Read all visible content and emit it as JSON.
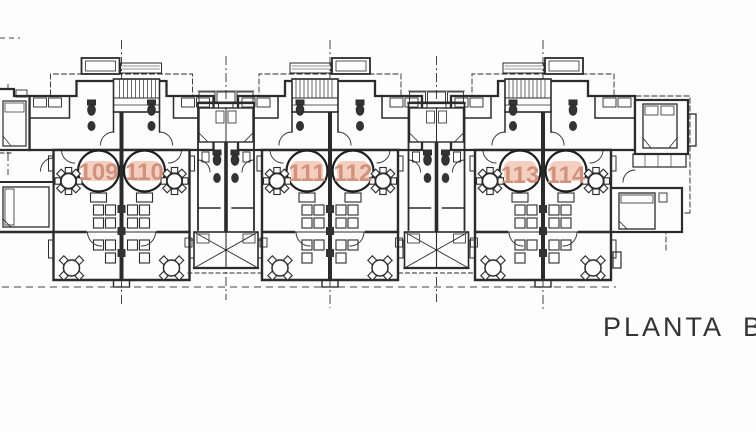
{
  "floor_plan": {
    "title": "PLANTA BA",
    "units": [
      {
        "number": "109"
      },
      {
        "number": "110"
      },
      {
        "number": "111"
      },
      {
        "number": "112"
      },
      {
        "number": "113"
      },
      {
        "number": "114"
      }
    ]
  },
  "colors": {
    "background": "#fdfdfd",
    "line": "#2b2b2b",
    "unit_highlight": "#f4cfc0",
    "unit_number": "#d0917d",
    "title_text": "#333333"
  },
  "symbols": {
    "stairs-icon": "hatched stair treads",
    "round-table-icon": "circle table with chair squares",
    "double-bed-icon": "rectangle bed with fold lines",
    "toilet-icon": "dark fixture ellipse"
  }
}
